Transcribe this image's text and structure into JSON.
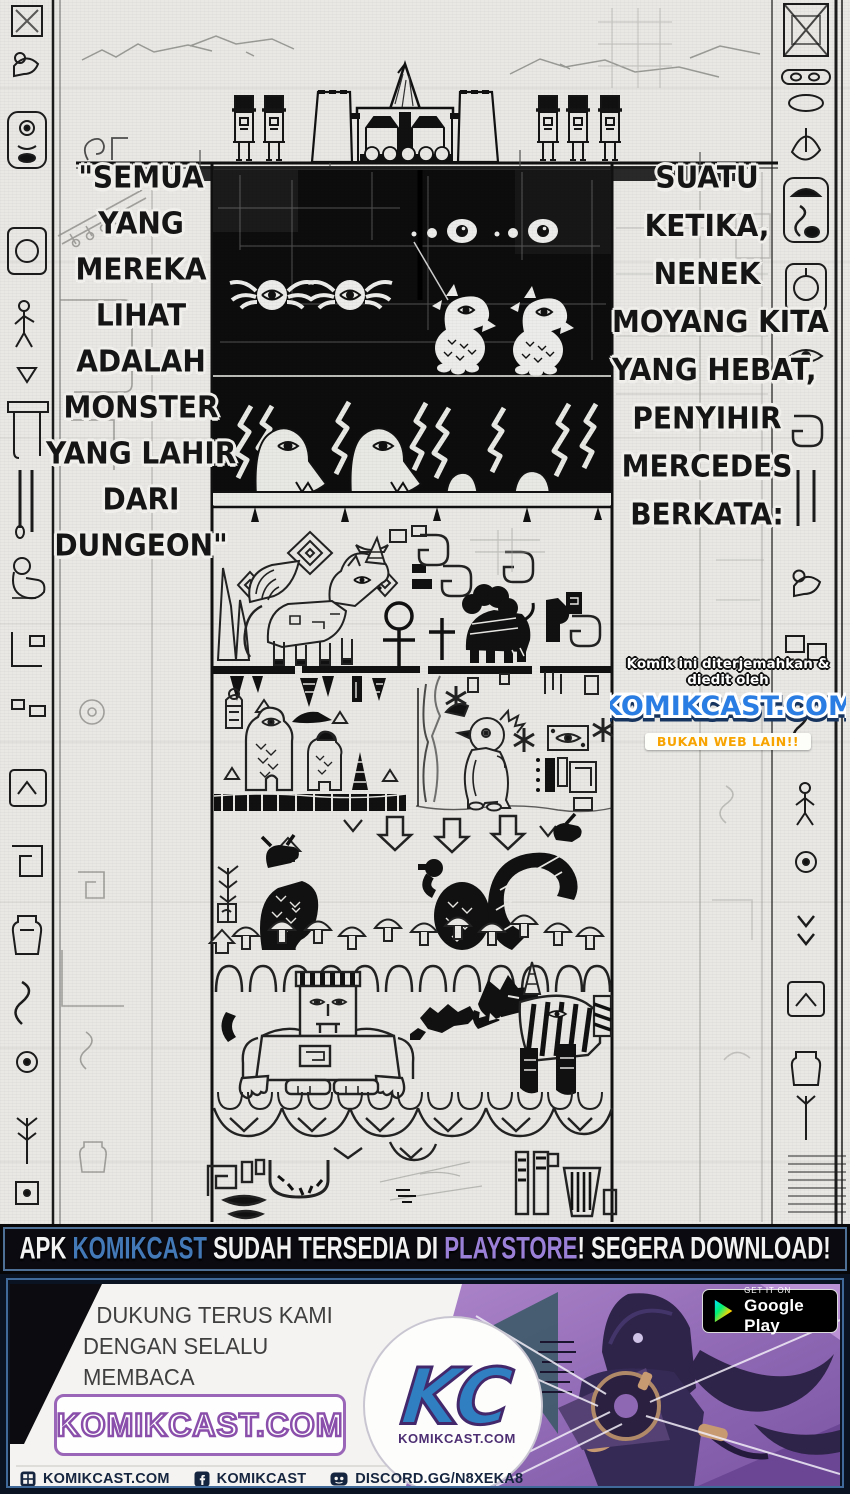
{
  "speech_left": {
    "lines": [
      "\"SEMUA",
      "YANG",
      "MEREKA",
      "LIHAT",
      "ADALAH",
      "MONSTER",
      "YANG LAHIR",
      "DARI",
      "DUNGEON\""
    ]
  },
  "speech_right": {
    "lines": [
      "SUATU",
      "KETIKA,",
      "NENEK",
      "MOYANG KITA",
      "YANG HEBAT,",
      "PENYIHIR",
      "MERCEDES",
      "BERKATA:"
    ]
  },
  "watermark": {
    "credit": "Komik ini diterjemahkan & diedit oleh",
    "site": "KOMIKCAST.COM",
    "tagline": "BUKAN WEB LAIN!!"
  },
  "promo_banner": {
    "segments": [
      {
        "text": "APK ",
        "color": "#f2f2f2"
      },
      {
        "text": "KOMIKCAST",
        "color": "#4479b8"
      },
      {
        "text": " SUDAH TERSEDIA DI ",
        "color": "#f2f2f2"
      },
      {
        "text": "PLAYSTORE",
        "color": "#9b80d8"
      },
      {
        "text": "! SEGERA DOWNLOAD!",
        "color": "#f2f2f2"
      }
    ]
  },
  "footer": {
    "support_lines": [
      "DUKUNG TERUS KAMI",
      "DENGAN SELALU MEMBACA",
      "DAN BERKOMENTAR DI"
    ],
    "site_box_label": "KOMIKCAST.COM",
    "logo": {
      "monogram": "KC",
      "site": "KOMIKCAST.COM"
    },
    "play_badge": {
      "line1": "GET IT ON",
      "line2": "Google Play"
    }
  },
  "social_bar": {
    "items": [
      {
        "icon": "website-icon",
        "label": "KOMIKCAST.COM"
      },
      {
        "icon": "facebook-icon",
        "label": "KOMIKCAST"
      },
      {
        "icon": "discord-icon",
        "label": "DISCORD.GG/N8XEKA8"
      }
    ]
  },
  "colors": {
    "paper": "#e9e8e5",
    "ink": "#111111",
    "banner_blue": "#4479b8",
    "banner_purple": "#9b80d8",
    "watermark_blue": "#2a7de2",
    "tagline_orange": "#f7a400",
    "footer_purple": "#8a4faa",
    "navy": "#16253f"
  }
}
